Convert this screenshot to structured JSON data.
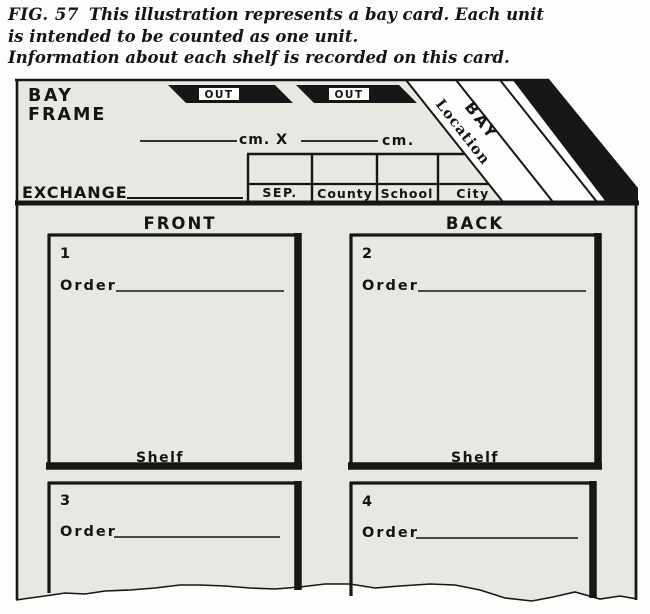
{
  "caption": {
    "fig_label": "FIG. 57",
    "line1": "This illustration represents a bay card. Each unit",
    "line2": "is intended to be counted as one unit.",
    "line3": "Information about each shelf is recorded on this card."
  },
  "card": {
    "title_line1": "BAY",
    "title_line2": "FRAME",
    "out_tabs": [
      "OUT",
      "OUT"
    ],
    "corner_labels": {
      "location": "Location",
      "bay": "BAY"
    },
    "dimensions": {
      "unit1": "cm.",
      "separator": "X",
      "unit2": "cm."
    },
    "exchange_label": "EXCHANGE",
    "type_table": {
      "columns": [
        "SEP.",
        "County",
        "School",
        "City"
      ]
    },
    "sections": {
      "front": "FRONT",
      "back": "BACK"
    },
    "units": [
      {
        "number": "1",
        "order_label": "Order",
        "shelf_label": "Shelf"
      },
      {
        "number": "2",
        "order_label": "Order",
        "shelf_label": "Shelf"
      },
      {
        "number": "3",
        "order_label": "Order"
      },
      {
        "number": "4",
        "order_label": "Order"
      }
    ],
    "colors": {
      "card_fill": "#e9e7e2",
      "ink": "#161616",
      "paper": "#fdfdfb",
      "underline": "#5c5148"
    }
  }
}
